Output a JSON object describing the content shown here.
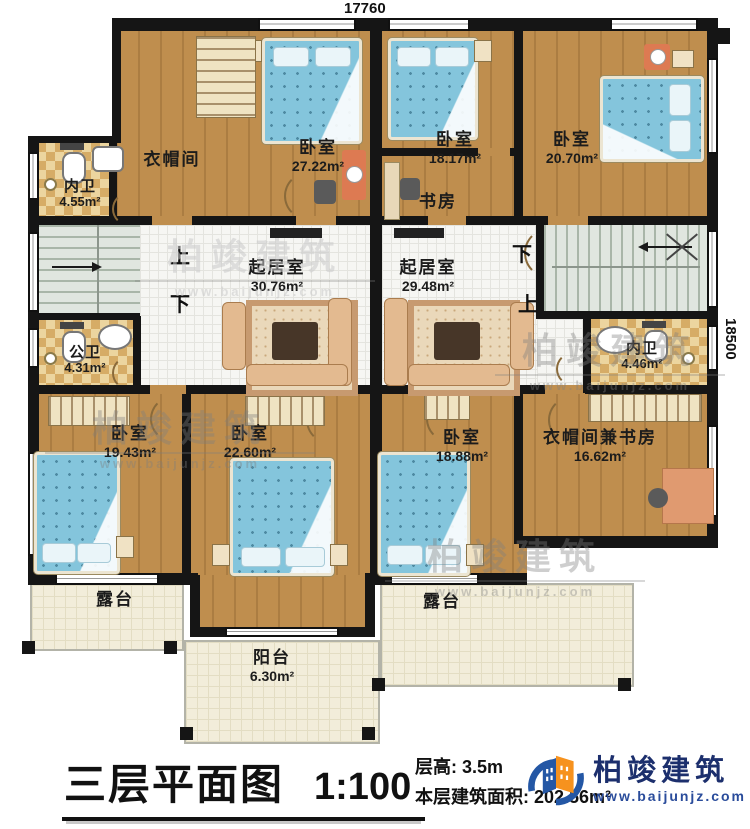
{
  "title": {
    "plan_name": "三层平面图",
    "scale": "1:100",
    "floor_height": "层高: 3.5m",
    "floor_area": "本层建筑面积: 202.56m²"
  },
  "logo": {
    "company": "柏竣建筑",
    "website": "www.baijunjz.com"
  },
  "watermark": {
    "company": "柏竣建筑",
    "website": "www.baijunjz.com"
  },
  "dimensions": {
    "top": "17760",
    "right": "18500"
  },
  "stairs": {
    "left_up": "上",
    "left_down": "下",
    "right_down": "下",
    "right_up": "上"
  },
  "rooms": [
    {
      "name": "衣帽间",
      "area": ""
    },
    {
      "name": "卧室",
      "area": "27.22m²"
    },
    {
      "name": "内卫",
      "area": "4.55m²"
    },
    {
      "name": "卧室",
      "area": "18.17m²"
    },
    {
      "name": "书房",
      "area": ""
    },
    {
      "name": "卧室",
      "area": "20.70m²"
    },
    {
      "name": "起居室",
      "area": "30.76m²"
    },
    {
      "name": "起居室",
      "area": "29.48m²"
    },
    {
      "name": "公卫",
      "area": "4.31m²"
    },
    {
      "name": "内卫",
      "area": "4.46m²"
    },
    {
      "name": "卧室",
      "area": "19.43m²"
    },
    {
      "name": "卧室",
      "area": "22.60m²"
    },
    {
      "name": "卧室",
      "area": "18.88m²"
    },
    {
      "name": "衣帽间兼书房",
      "area": "16.62m²"
    },
    {
      "name": "露台",
      "area": ""
    },
    {
      "name": "露台",
      "area": ""
    },
    {
      "name": "阳台",
      "area": "6.30m²"
    }
  ],
  "colors": {
    "wood": "#bf8e4e",
    "wall": "#151515",
    "bed": "#84c5dc",
    "tile": "#d6ac66",
    "terrace": "#f2edda",
    "logo_blue": "#2457a5",
    "logo_orange": "#f6921e",
    "logo_text": "#1c2f6d"
  }
}
